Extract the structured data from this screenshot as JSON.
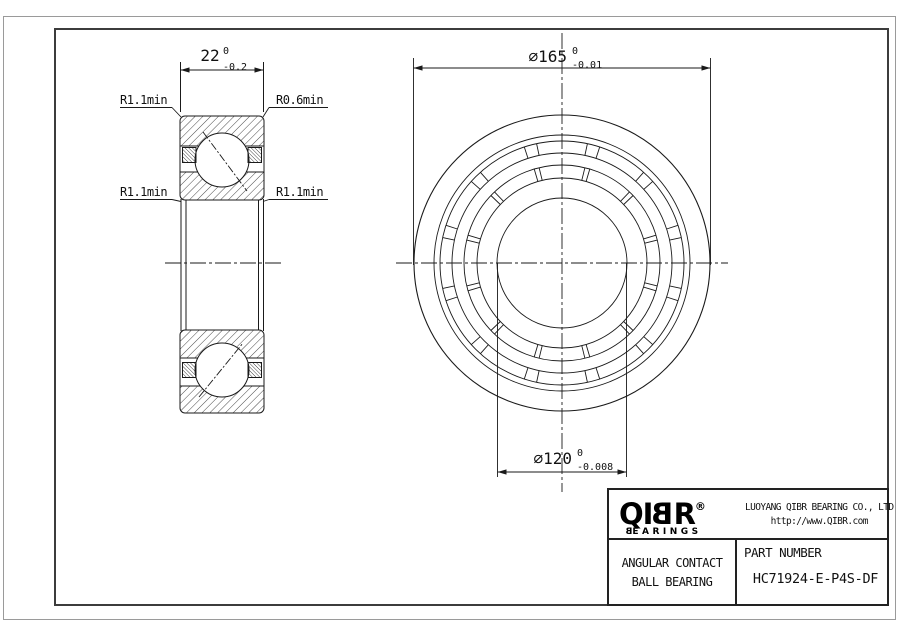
{
  "drawing": {
    "section": {
      "width_dim": {
        "main": "22",
        "tol_top": "0",
        "tol_bottom": "-0.2"
      },
      "fillet_top_left": "R1.1min",
      "fillet_top_right": "R0.6min",
      "fillet_mid_left": "R1.1min",
      "fillet_mid_right": "R1.1min"
    },
    "front": {
      "outer_dim": {
        "main": "∅165",
        "tol_top": "0",
        "tol_bottom": "-0.01"
      },
      "bore_dim": {
        "main": "∅120",
        "tol_top": "0",
        "tol_bottom": "-0.008"
      }
    }
  },
  "title_block": {
    "logo": {
      "prefix": "QI",
      "mirrored_letter": "B",
      "suffix": "R",
      "registered": "®",
      "sub_first": "B",
      "sub_rest": "EARINGS"
    },
    "company": "LUOYANG QIBR BEARING CO., LTD",
    "website": "http://www.QIBR.com",
    "product_line1": "ANGULAR CONTACT",
    "product_line2": "BALL BEARING",
    "part_number_label": "PART NUMBER",
    "part_number": "HC71924-E-P4S-DF"
  },
  "colors": {
    "line": "#1a1a1a",
    "frame_outer": "#9a9a9a",
    "frame_inner": "#3c3c3c",
    "background": "#ffffff"
  }
}
